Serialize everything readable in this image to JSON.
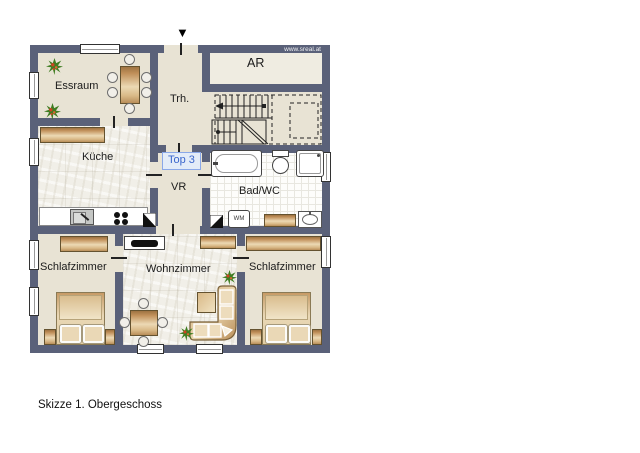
{
  "watermark": "www.sreal.at",
  "caption": "Skizze 1. Obergeschoss",
  "unit_badge": "Top 3",
  "rooms": {
    "essraum": "Essraum",
    "treppenhaus": "Trh.",
    "abstellraum": "AR",
    "kueche": "Küche",
    "vorraum": "VR",
    "bad_wc": "Bad/WC",
    "schlafzimmer_links": "Schlafzimmer",
    "wohnzimmer": "Wohnzimmer",
    "schlafzimmer_rechts": "Schlafzimmer"
  },
  "appliances": {
    "waschmaschine": "WM"
  },
  "symbols": {
    "entrance_marker": "▼"
  },
  "colors": {
    "wall": "#5a6179",
    "floor_beige": "#e8e3d4",
    "floor_tile": "#f1efe8",
    "furniture_tan": "#c1905a",
    "badge_text": "#3a66cc",
    "badge_border": "#8aa8e8"
  }
}
